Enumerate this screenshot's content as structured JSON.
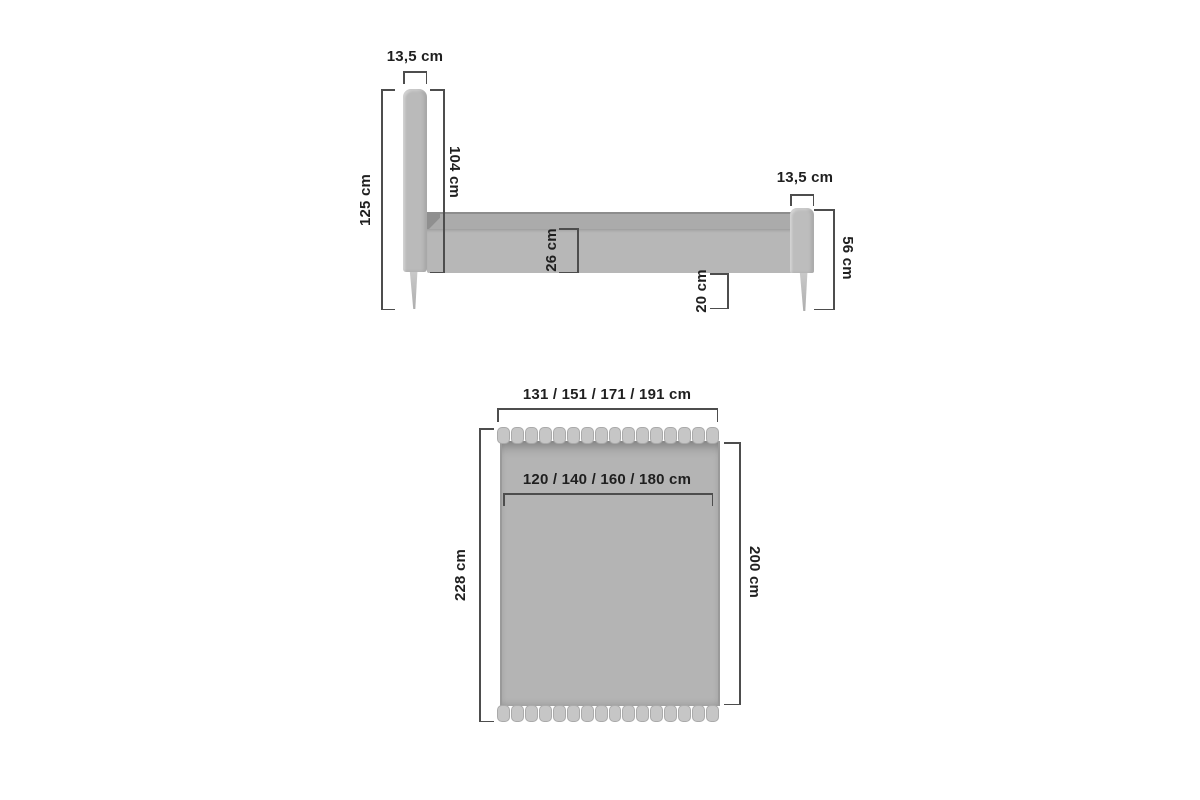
{
  "diagram": {
    "type": "furniture-dimension-diagram",
    "subject": "upholstered bed with channel-tufted headboard, side view and top view",
    "units": "cm"
  },
  "side_view": {
    "headboard_thickness": "13,5 cm",
    "total_height": "125 cm",
    "headboard_height": "104 cm",
    "frame_side_height": "26 cm",
    "floor_clearance": "20 cm",
    "footboard_thickness": "13,5 cm",
    "footboard_height": "56 cm"
  },
  "top_view": {
    "overall_width": "131 / 151 / 171 / 191 cm",
    "mattress_width": "120 / 140 / 160 / 180  cm",
    "overall_length": "228 cm",
    "mattress_length": "200 cm",
    "slat_count": 16
  },
  "colors": {
    "background": "#ffffff",
    "bed_fill": "#b9b9b9",
    "mattress_fill": "#ababab",
    "slat_fill": "#c6c6c6",
    "frame_edge": "#8d8d8d",
    "dimension_line": "#4d4d4d",
    "label_text": "#1f1f1f"
  }
}
